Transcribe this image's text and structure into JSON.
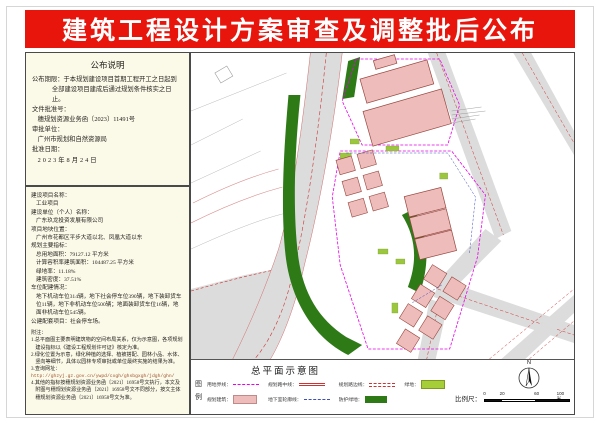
{
  "banner": {
    "title": "建筑工程设计方案审查及调整批后公布"
  },
  "notice": {
    "title": "公布说明",
    "lines": [
      {
        "t": "公布期限：于本规划建设项目首期工程开工之日起到全部建设项目建成后通过规划条件核实之日止。",
        "hang": true
      },
      {
        "t": "文件批准号："
      },
      {
        "t": "穗规划资源业务函〔2023〕11491号",
        "i": 1
      },
      {
        "t": "审批单位："
      },
      {
        "t": "广州市规划和自然资源局",
        "i": 1
      },
      {
        "t": "批准日期："
      },
      {
        "t": "2023年8月24日",
        "i": 1,
        "cls": "sp"
      }
    ]
  },
  "project": {
    "lines": [
      {
        "t": "建设项目名称："
      },
      {
        "t": "工业项目",
        "i": 1
      },
      {
        "t": "建设单位（个人）名称："
      },
      {
        "t": "广东玖龙投资发展有限公司",
        "i": 1
      },
      {
        "t": "项目地块位置："
      },
      {
        "t": "广州市花都区平步大道以北、凤凰大道以东",
        "i": 1
      },
      {
        "t": "规划主要指标："
      },
      {
        "t": "总用地面积：79127.12 平方米",
        "i": 1
      },
      {
        "t": "计算容积率建筑面积：104487.25 平方米",
        "i": 1
      },
      {
        "t": "绿地率：11.18%",
        "i": 1
      },
      {
        "t": "建筑密度：37.51%",
        "i": 1
      },
      {
        "t": "车位配建情况："
      },
      {
        "t": "地下机动车位314辆，地下社会停车位390辆，地下装卸货车位11辆，地下非机动车位500辆；地面装卸货车位16辆，地面非机动车位545辆。",
        "i": 1
      },
      {
        "t": "公建配套项目：社会停车场。"
      }
    ]
  },
  "notes": {
    "lines": [
      {
        "t": "附注："
      },
      {
        "t": "1.总平面图主要表明建筑物的空间布局关系，仅为示意图，各项规划建设指标以《建设工程规划许可证》核定为准。",
        "cls": "hang2"
      },
      {
        "t": "2.绿化位置为示意，绿化种植的选择、植被搭配、园林小品、水体、竖向等细节，具体以园林专项审批或单位最终实施的结果为准。",
        "cls": "hang2"
      },
      {
        "t": "3.查询网址："
      },
      {
        "t": "http://ghzyj.gz.gov.cn/ywpd/cxgh/ghsbgxgh/jdgh/ghn/",
        "cls": "url"
      },
      {
        "t": "4.其他的指标按穗规划资源业务函〔2021〕16958号文执行，本文及附图与穗规划资源业务函〔2021〕16958号文不同部分，按文主体穗规划资源业务函〔2021〕16958号文为准。",
        "cls": "hang2"
      }
    ]
  },
  "map": {
    "title": "总平面示意图",
    "legend_title_chars": [
      "图",
      "例"
    ],
    "legend": [
      {
        "label": "用地界线：",
        "type": "magenta-dashdot-line"
      },
      {
        "label": "规划路中线：",
        "type": "red-double-line"
      },
      {
        "label": "规划路边线：",
        "type": "red-dashed-line"
      },
      {
        "label": "绿地：",
        "type": "light-green-fill"
      },
      {
        "label": "规划建筑：",
        "type": "pink-fill"
      },
      {
        "label": "地下室轮廓线：",
        "type": "blue-dashed-line"
      },
      {
        "label": "防护绿地：",
        "type": "dark-green-fill"
      }
    ],
    "north_label": "N",
    "scale": {
      "label": "比例尺：",
      "ticks": [
        "0",
        "20",
        "60",
        "100米"
      ]
    }
  },
  "colors": {
    "banner_red": "#e8150d",
    "panel_bg": "#fbfae9",
    "building_pink": "#efbcbc",
    "green_dark": "#2e7a17",
    "green_light": "#a6ce39",
    "boundary_magenta": "#e800e8",
    "road_gray": "#dcdcdc",
    "road_line_red": "#cc3333",
    "basement_blue": "#3c4fbb"
  }
}
